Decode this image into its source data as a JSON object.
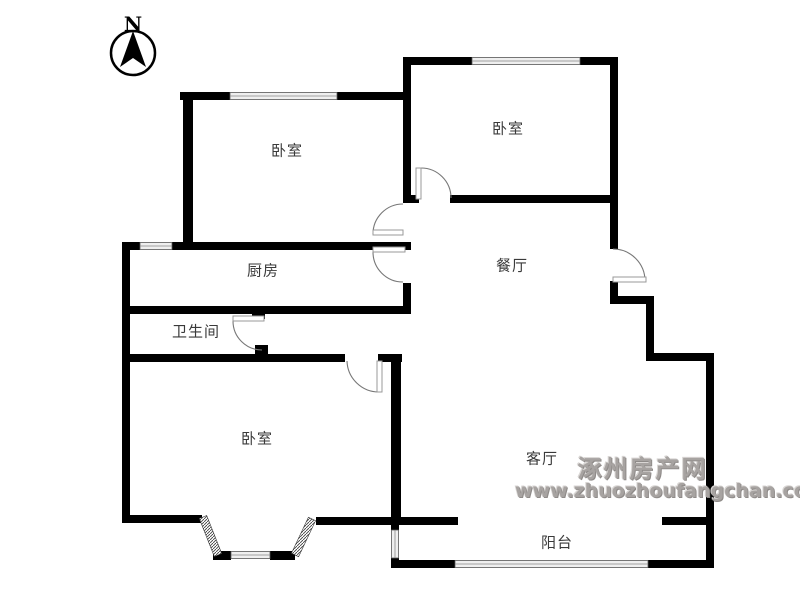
{
  "compass": {
    "label": "N"
  },
  "rooms": {
    "bedroom_top_left": {
      "label": "卧室"
    },
    "bedroom_top_right": {
      "label": "卧室"
    },
    "bedroom_bottom_left": {
      "label": "卧室"
    },
    "kitchen": {
      "label": "厨房"
    },
    "bathroom": {
      "label": "卫生间"
    },
    "dining": {
      "label": "餐厅"
    },
    "living": {
      "label": "客厅"
    },
    "balcony": {
      "label": "阳台"
    }
  },
  "watermark": {
    "site_name": "涿州房产网",
    "site_url": "www.zhuozhoufangchan.com",
    "color": "#a7a3a1"
  },
  "colors": {
    "wall": "#000000",
    "door_arc": "#777777",
    "window_band": "#efefef",
    "background": "#ffffff"
  }
}
